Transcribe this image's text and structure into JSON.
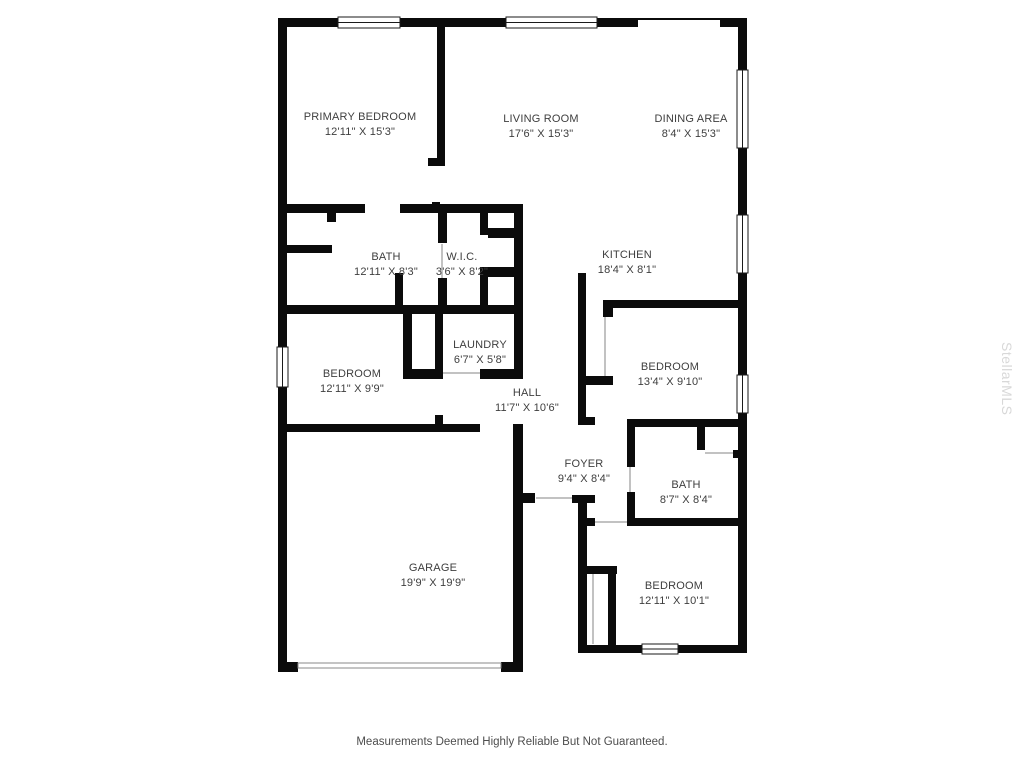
{
  "page": {
    "background": "#ffffff"
  },
  "watermark": {
    "text": "StellarMLS",
    "color": "#d8d8d8"
  },
  "disclaimer": {
    "text": "Measurements Deemed Highly Reliable But Not Guaranteed."
  },
  "floorplan": {
    "wall_color": "#0b0b0b",
    "window_frame_color": "#1a1a1a",
    "door_line_color": "#c2c2c2",
    "label_color": "#3e3e3e",
    "rooms": [
      {
        "id": "primary-bedroom",
        "name": "PRIMARY BEDROOM",
        "dims": "12'11\" X 15'3\"",
        "x": 360,
        "ny": 116,
        "dy": 131
      },
      {
        "id": "living-room",
        "name": "LIVING ROOM",
        "dims": "17'6\" X 15'3\"",
        "x": 541,
        "ny": 118,
        "dy": 133
      },
      {
        "id": "dining-area",
        "name": "DINING AREA",
        "dims": "8'4\" X 15'3\"",
        "x": 691,
        "ny": 118,
        "dy": 133
      },
      {
        "id": "bath-primary",
        "name": "BATH",
        "dims": "12'11\" X 8'3\"",
        "x": 386,
        "ny": 256,
        "dy": 271
      },
      {
        "id": "wic",
        "name": "W.I.C.",
        "dims": "3'6\" X 8'2\"",
        "x": 462,
        "ny": 256,
        "dy": 271
      },
      {
        "id": "kitchen",
        "name": "KITCHEN",
        "dims": "18'4\" X 8'1\"",
        "x": 627,
        "ny": 254,
        "dy": 269
      },
      {
        "id": "laundry",
        "name": "LAUNDRY",
        "dims": "6'7\" X 5'8\"",
        "x": 480,
        "ny": 344,
        "dy": 359
      },
      {
        "id": "bedroom-west",
        "name": "BEDROOM",
        "dims": "12'11\" X 9'9\"",
        "x": 352,
        "ny": 373,
        "dy": 388
      },
      {
        "id": "hall",
        "name": "HALL",
        "dims": "11'7\" X 10'6\"",
        "x": 527,
        "ny": 392,
        "dy": 407
      },
      {
        "id": "bedroom-east",
        "name": "BEDROOM",
        "dims": "13'4\" X 9'10\"",
        "x": 670,
        "ny": 366,
        "dy": 381
      },
      {
        "id": "foyer",
        "name": "FOYER",
        "dims": "9'4\" X 8'4\"",
        "x": 584,
        "ny": 463,
        "dy": 478
      },
      {
        "id": "bath-hall",
        "name": "BATH",
        "dims": "8'7\" X 8'4\"",
        "x": 686,
        "ny": 484,
        "dy": 499
      },
      {
        "id": "garage",
        "name": "GARAGE",
        "dims": "19'9\" X 19'9\"",
        "x": 433,
        "ny": 567,
        "dy": 582
      },
      {
        "id": "bedroom-south",
        "name": "BEDROOM",
        "dims": "12'11\" X 10'1\"",
        "x": 674,
        "ny": 585,
        "dy": 600
      }
    ],
    "walls": [
      [
        278,
        18,
        9,
        329
      ],
      [
        278,
        387,
        9,
        285
      ],
      [
        278,
        18,
        60,
        9
      ],
      [
        400,
        18,
        106,
        9
      ],
      [
        597,
        18,
        41,
        9
      ],
      [
        720,
        18,
        27,
        9
      ],
      [
        738,
        18,
        9,
        52
      ],
      [
        738,
        148,
        9,
        67
      ],
      [
        738,
        273,
        9,
        102
      ],
      [
        738,
        413,
        9,
        240
      ],
      [
        578,
        645,
        64,
        8
      ],
      [
        678,
        645,
        69,
        8
      ],
      [
        578,
        495,
        9,
        158
      ],
      [
        278,
        424,
        202,
        8
      ],
      [
        513,
        424,
        10,
        248
      ],
      [
        278,
        662,
        20,
        10
      ],
      [
        501,
        662,
        22,
        10
      ],
      [
        523,
        493,
        12,
        10
      ],
      [
        572,
        495,
        23,
        8
      ],
      [
        437,
        27,
        8,
        138
      ],
      [
        428,
        158,
        17,
        8
      ],
      [
        432,
        202,
        8,
        11
      ],
      [
        278,
        204,
        87,
        9
      ],
      [
        400,
        204,
        123,
        9
      ],
      [
        327,
        213,
        9,
        9
      ],
      [
        278,
        245,
        54,
        8
      ],
      [
        395,
        273,
        8,
        32
      ],
      [
        438,
        213,
        9,
        30
      ],
      [
        438,
        278,
        9,
        35
      ],
      [
        480,
        213,
        8,
        22
      ],
      [
        480,
        267,
        8,
        46
      ],
      [
        488,
        228,
        29,
        10
      ],
      [
        488,
        267,
        29,
        10
      ],
      [
        514,
        204,
        9,
        175
      ],
      [
        278,
        305,
        245,
        9
      ],
      [
        403,
        314,
        9,
        65
      ],
      [
        435,
        314,
        8,
        55
      ],
      [
        403,
        369,
        40,
        10
      ],
      [
        480,
        369,
        43,
        10
      ],
      [
        435,
        415,
        8,
        9
      ],
      [
        578,
        273,
        8,
        152
      ],
      [
        603,
        300,
        143,
        8
      ],
      [
        603,
        300,
        10,
        17
      ],
      [
        586,
        376,
        27,
        9
      ],
      [
        578,
        417,
        17,
        8
      ],
      [
        627,
        419,
        119,
        8
      ],
      [
        627,
        419,
        8,
        48
      ],
      [
        627,
        492,
        8,
        34
      ],
      [
        697,
        427,
        8,
        23
      ],
      [
        733,
        450,
        9,
        8
      ],
      [
        578,
        518,
        17,
        8
      ],
      [
        627,
        518,
        119,
        8
      ],
      [
        587,
        566,
        30,
        8
      ],
      [
        608,
        566,
        8,
        79
      ]
    ],
    "windows": [
      {
        "x": 277,
        "y": 347,
        "w": 11,
        "h": 40,
        "o": "v"
      },
      {
        "x": 338,
        "y": 17,
        "w": 62,
        "h": 11,
        "o": "h"
      },
      {
        "x": 506,
        "y": 17,
        "w": 91,
        "h": 11,
        "o": "h"
      },
      {
        "x": 737,
        "y": 70,
        "w": 11,
        "h": 78,
        "o": "v"
      },
      {
        "x": 737,
        "y": 215,
        "w": 11,
        "h": 58,
        "o": "v"
      },
      {
        "x": 737,
        "y": 375,
        "w": 11,
        "h": 38,
        "o": "v"
      },
      {
        "x": 642,
        "y": 644,
        "w": 36,
        "h": 10,
        "o": "h"
      }
    ],
    "slider_door": {
      "x": 638,
      "y": 18,
      "w": 82,
      "h": 2
    },
    "garage_door": {
      "x": 298,
      "y": 663,
      "w": 203,
      "h": 5
    },
    "door_lines": [
      [
        443,
        372,
        37,
        2
      ],
      [
        604,
        317,
        2,
        59
      ],
      [
        705,
        452,
        28,
        2
      ],
      [
        595,
        521,
        32,
        2
      ],
      [
        592,
        574,
        2,
        70
      ],
      [
        629,
        467,
        2,
        25
      ],
      [
        536,
        497,
        36,
        2
      ],
      [
        441,
        244,
        2,
        34
      ]
    ]
  }
}
